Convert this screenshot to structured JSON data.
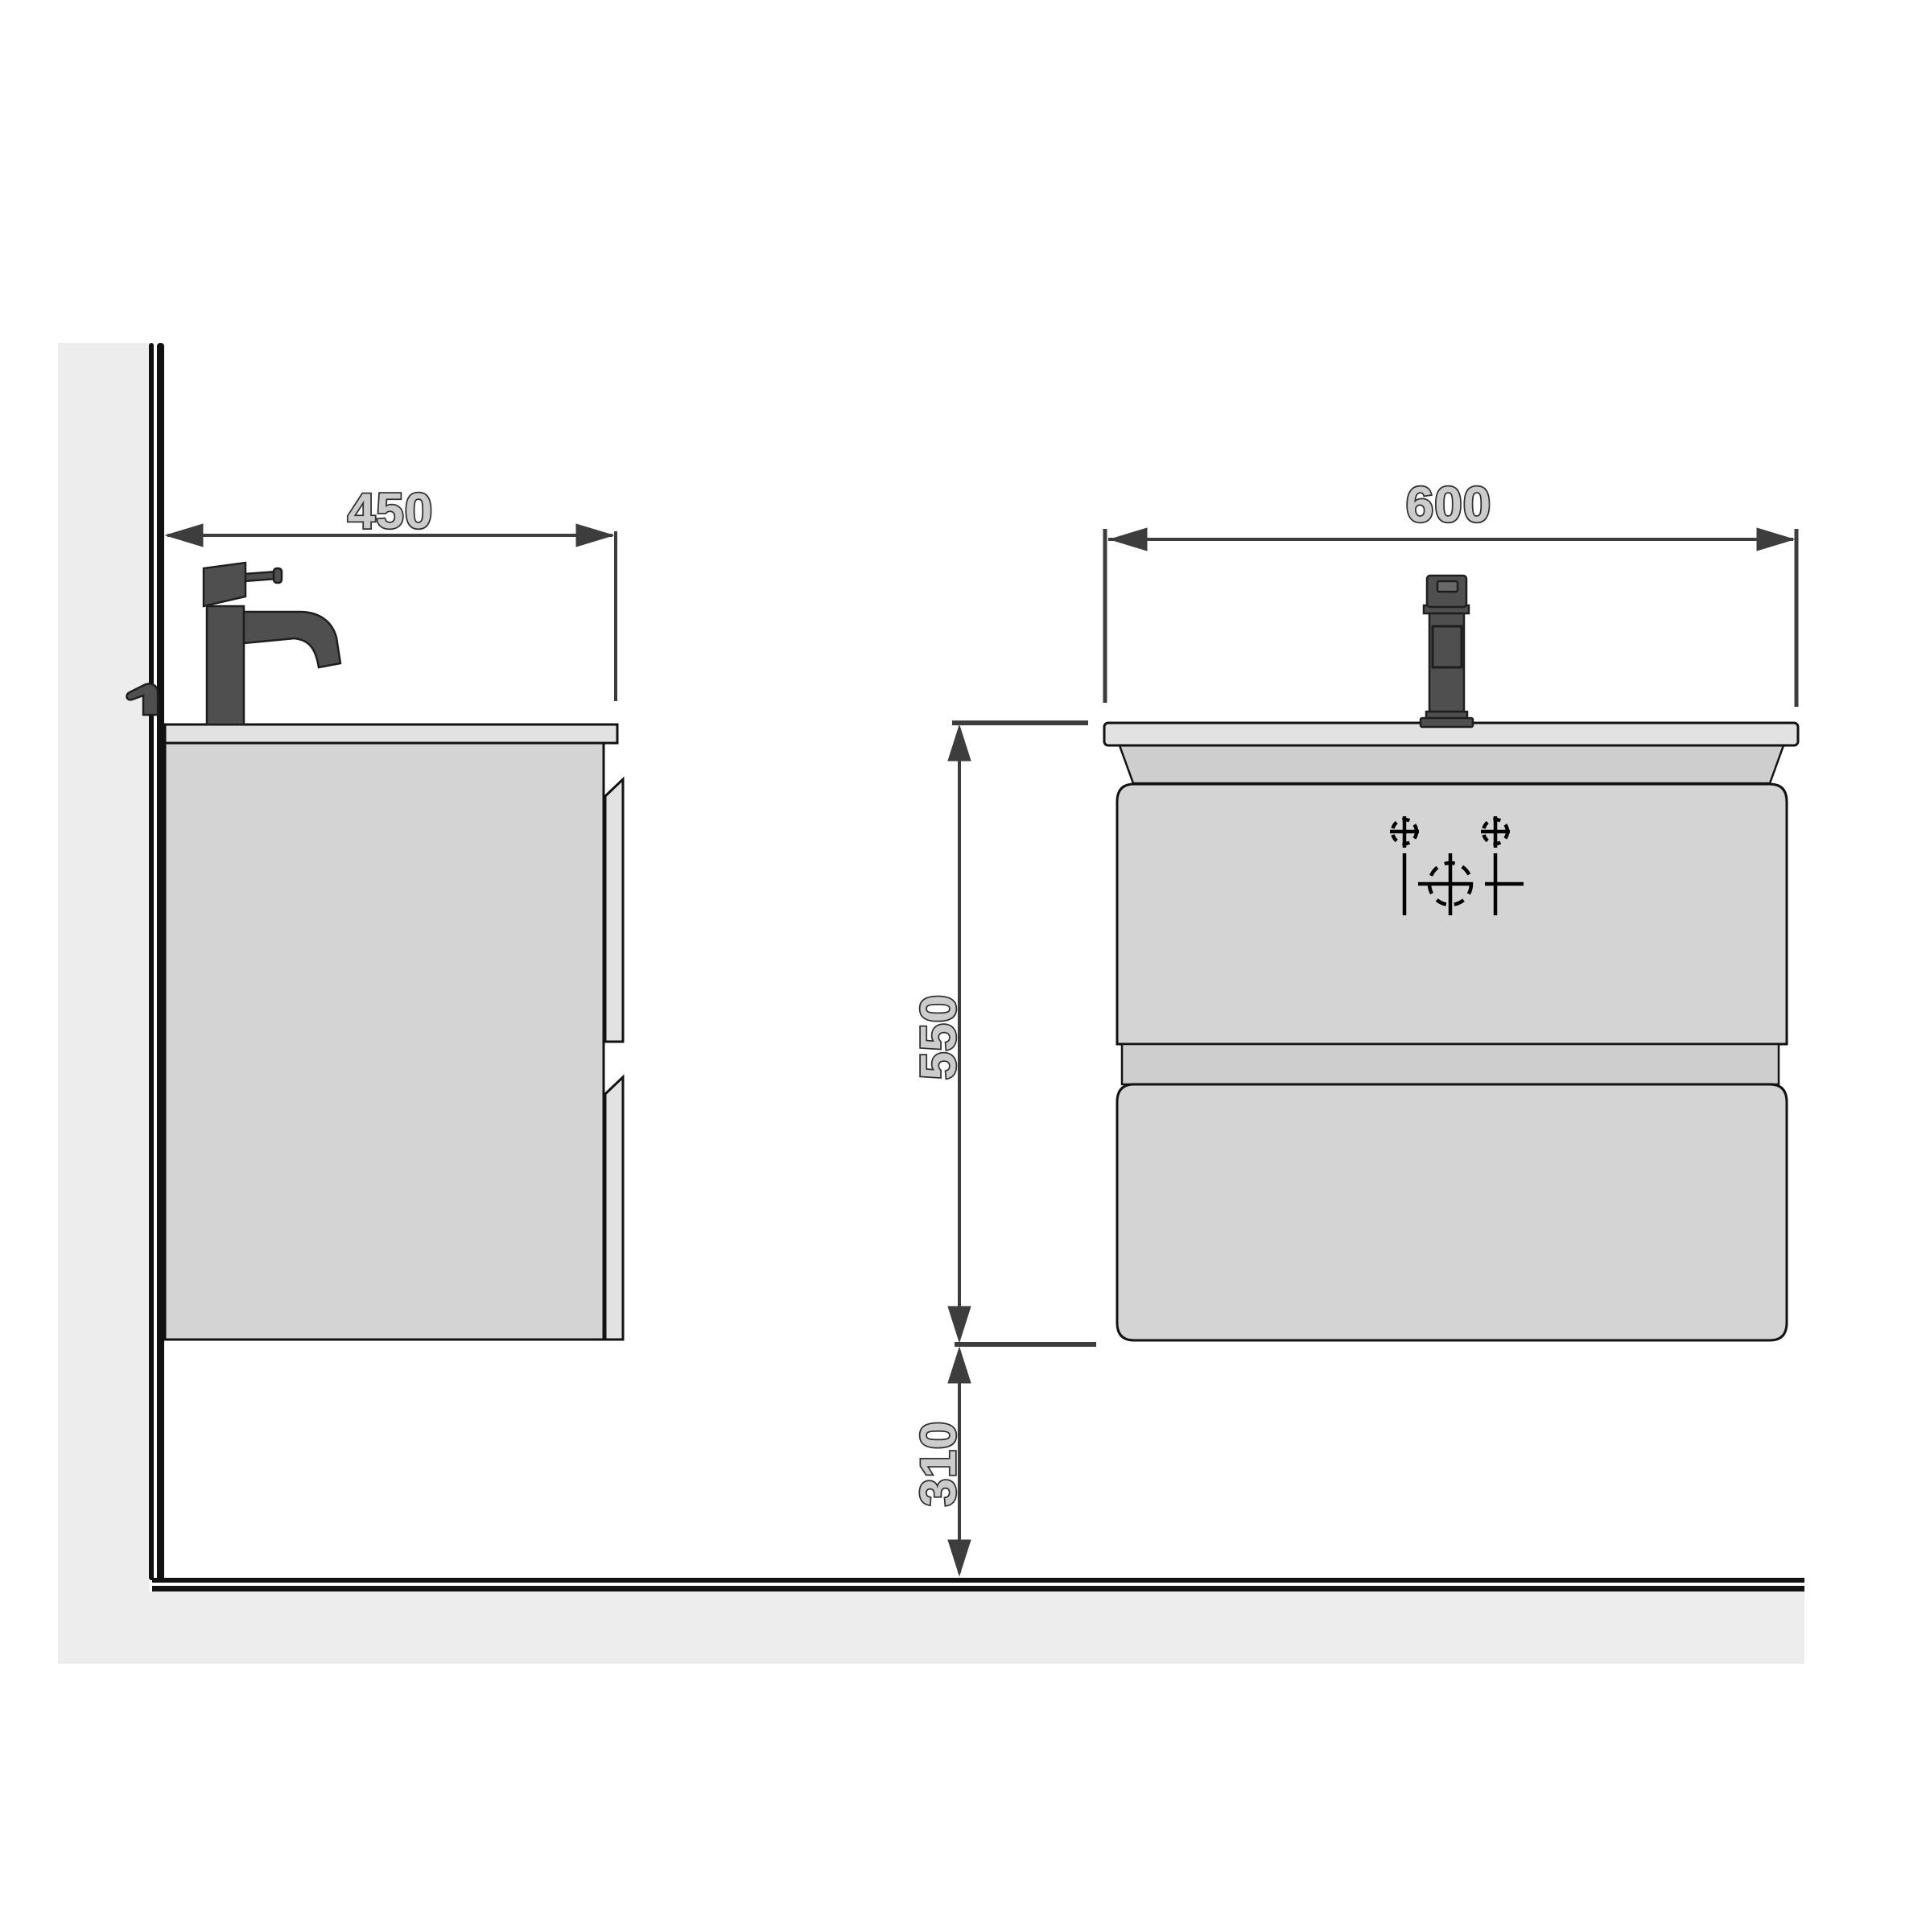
{
  "dimensions": {
    "side_depth": {
      "label": "450"
    },
    "front_width": {
      "label": "600"
    },
    "cabinet_height": {
      "label": "550"
    },
    "floor_clearance": {
      "label": "310"
    }
  },
  "colors": {
    "wall_fill": "#ededed",
    "line_dark": "#121212",
    "cabinet_fill": "#d4d4d4",
    "cabinet_fill_dark": "#cecece",
    "countertop_fill": "#e2e2e2",
    "faucet_fill": "#4f4f4f",
    "dim_line": "#3d3d3d",
    "dim_text_fill": "#cccccc",
    "dim_text_stroke": "#303030",
    "symbol_color": "#000000"
  }
}
